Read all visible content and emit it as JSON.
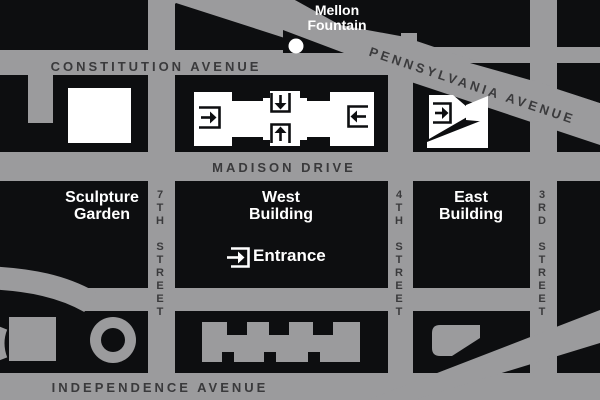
{
  "map": {
    "streets": {
      "constitution": "CONSTITUTION AVENUE",
      "pennsylvania": "PENNSYLVANIA AVENUE",
      "madison": "MADISON DRIVE",
      "independence": "INDEPENDENCE AVENUE",
      "seventh": "7TH STREET",
      "fourth": "4TH STREET",
      "third": "3RD STREET"
    },
    "landmarks": {
      "mellon_line1": "Mellon",
      "mellon_line2": "Fountain",
      "sculpture_line1": "Sculpture",
      "sculpture_line2": "Garden",
      "west_line1": "West",
      "west_line2": "Building",
      "east_line1": "East",
      "east_line2": "Building",
      "entrance": "Entrance"
    },
    "icons": [
      "entrance-arrow-west-icon",
      "entrance-arrow-down-icon",
      "entrance-arrow-up-icon",
      "entrance-arrow-east-icon",
      "entrance-arrow-eastbuilding-icon",
      "entrance-marker-icon",
      "fountain-dot-icon"
    ],
    "colors": {
      "street_gray": "#9b9b9d",
      "block_black": "#0d0e10",
      "building_white": "#ffffff",
      "street_text": "#3a3a3c",
      "label_text": "#ffffff"
    }
  }
}
